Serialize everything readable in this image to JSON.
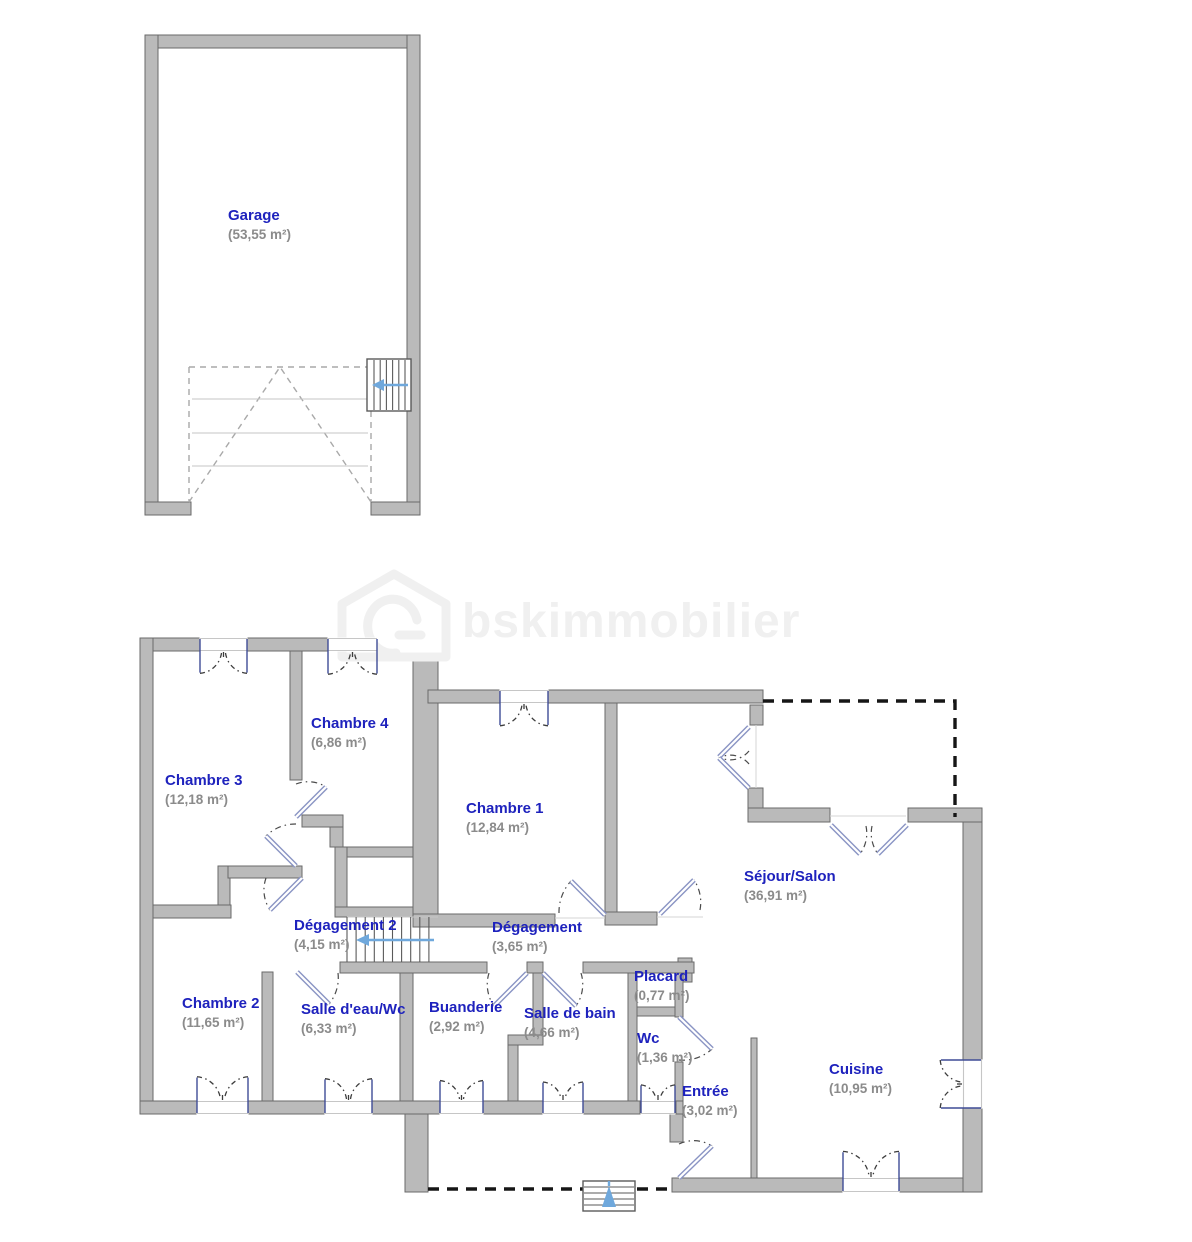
{
  "watermark": {
    "text": "bskimmobilier"
  },
  "rooms": [
    {
      "id": "garage",
      "name": "Garage",
      "area": "(53,55 m²)"
    },
    {
      "id": "chambre3",
      "name": "Chambre 3",
      "area": "(12,18 m²)"
    },
    {
      "id": "chambre4",
      "name": "Chambre 4",
      "area": "(6,86 m²)"
    },
    {
      "id": "chambre1",
      "name": "Chambre 1",
      "area": "(12,84 m²)"
    },
    {
      "id": "degagement2",
      "name": "Dégagement 2",
      "area": "(4,15 m²)"
    },
    {
      "id": "degagement",
      "name": "Dégagement",
      "area": "(3,65 m²)"
    },
    {
      "id": "sejour",
      "name": "Séjour/Salon",
      "area": "(36,91 m²)"
    },
    {
      "id": "chambre2",
      "name": "Chambre 2",
      "area": "(11,65 m²)"
    },
    {
      "id": "salledeau",
      "name": "Salle d'eau/Wc",
      "area": "(6,33 m²)"
    },
    {
      "id": "buanderie",
      "name": "Buanderie",
      "area": "(2,92 m²)"
    },
    {
      "id": "salledebain",
      "name": "Salle de bain",
      "area": "(4,66 m²)"
    },
    {
      "id": "placard",
      "name": "Placard",
      "area": "(0,77 m²)"
    },
    {
      "id": "wc",
      "name": "Wc",
      "area": "(1,36 m²)"
    },
    {
      "id": "entree",
      "name": "Entrée",
      "area": "(3,02 m²)"
    },
    {
      "id": "cuisine",
      "name": "Cuisine",
      "area": "(10,95 m²)"
    }
  ],
  "stair_arrows": {
    "garage": "left",
    "interior": "left",
    "exterior": "up"
  },
  "colors": {
    "wall": "#bababa",
    "wallEdge": "#6a6a6a",
    "dash": "#161616",
    "door": "#8a94c4",
    "stairArrow": "#6fa8dc",
    "wm": "#f0f0f0",
    "winJamb": "#3f4c96",
    "roomName": "#1e22bd",
    "roomArea": "#8b8b8b"
  }
}
